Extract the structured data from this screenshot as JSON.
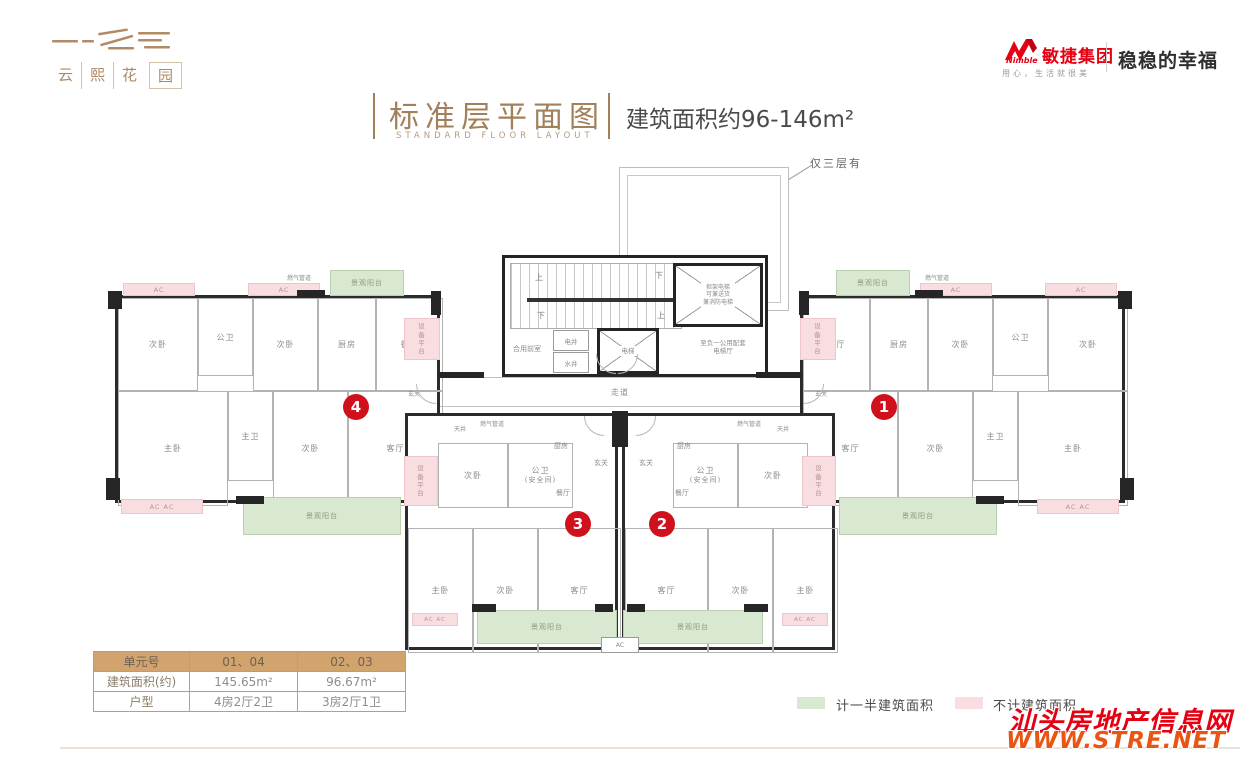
{
  "header": {
    "logo_chars": [
      "云",
      "熙",
      "花",
      "园"
    ],
    "brand": {
      "name_en": "Nimble",
      "name_cn": "敏捷集团",
      "tagline": "用心，生活就很美",
      "slogan": "稳稳的幸福"
    },
    "title": {
      "main": "标准层平面图",
      "sub": "STANDARD FLOOR LAYOUT",
      "area": "建筑面积约96-146m²"
    }
  },
  "plan": {
    "roof_note": "仅三层有",
    "unit_numbers": {
      "u1": "1",
      "u2": "2",
      "u3": "3",
      "u4": "4"
    },
    "core": {
      "up": "上",
      "down": "下",
      "shared_front": "合用前室",
      "elec": "电井",
      "water": "水井",
      "lift": "电梯",
      "stretcher_l1": "担架电梯",
      "stretcher_l2": "可兼送货",
      "stretcher_l3": "兼消防电梯",
      "hall_l1": "至负一公用配套",
      "hall_l2": "电梯厅",
      "corridor": "走道"
    },
    "rooms": {
      "bed": "次卧",
      "bath": "公卫",
      "kitchen": "厨房",
      "dining": "餐厅",
      "master": "主卧",
      "master_bath": "主卫",
      "living": "客厅",
      "foyer": "玄关",
      "safe_bath_l1": "公卫",
      "safe_bath_l2": "(安全间)",
      "courtyard": "天井"
    },
    "features": {
      "ac": "AC",
      "ac2": "AC  AC",
      "gas": "燃气管道",
      "balcony": "景观阳台",
      "equip": "设备平台"
    }
  },
  "table": {
    "headers": [
      "单元号",
      "01、04",
      "02、03"
    ],
    "rows": [
      [
        "建筑面积(约)",
        "145.65m²",
        "96.67m²"
      ],
      [
        "户型",
        "4房2厅2卫",
        "3房2厅1卫"
      ]
    ]
  },
  "legend": {
    "half": "计一半建筑面积",
    "half_color": "#d9e8d0",
    "none": "不计建筑面积",
    "none_color": "#f9dee1"
  },
  "watermark": {
    "site": "汕头房地产信息网",
    "url": "WWW.STRE.NET"
  },
  "colors": {
    "accent_brown": "#a1805a",
    "brand_red": "#e60012",
    "unit_marker_red": "#d0111d",
    "table_header_tan": "#d2a46d"
  }
}
